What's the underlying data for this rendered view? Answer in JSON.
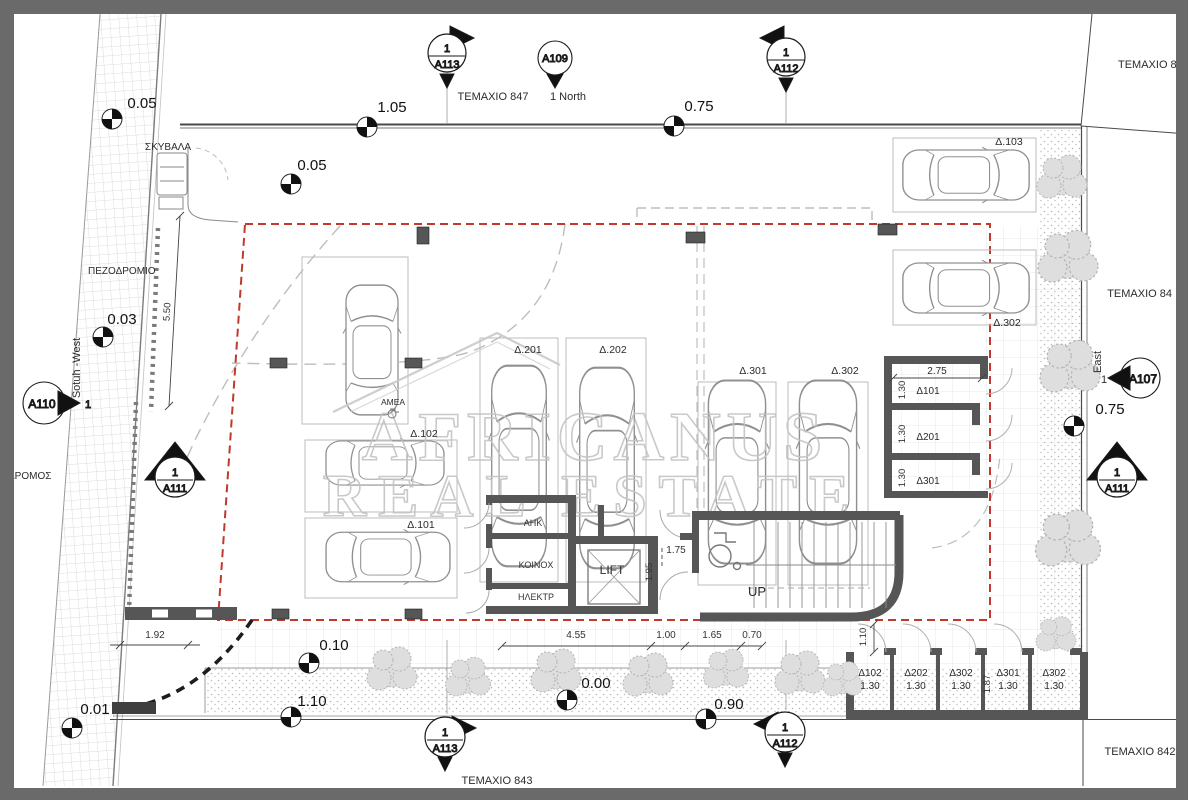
{
  "labels": {
    "temaxio_847": "ΤΕΜΑΧΙΟ 847",
    "temaxio_846": "ΤΕΜΑΧΙΟ 846",
    "temaxio_84": "ΤΕΜΑΧΙΟ 84",
    "temaxio_842": "ΤΕΜΑΧΙΟ 842",
    "temaxio_843": "ΤΕΜΑΧΙΟ 843",
    "north": "1 North",
    "east": "East",
    "east_num": "1",
    "south_west": "Sotuh -West",
    "sidewalk": "ΠΕΖΟΔΡΟΜΙΟ",
    "road": "ΔΡΟΜΟΣ",
    "garbage": "ΣΚΥΒΑΛΑ"
  },
  "sections": {
    "num": "1",
    "a113": "A113",
    "a112": "A112",
    "a111": "A111",
    "a110": "A110",
    "a109": "A109",
    "a107": "A107"
  },
  "levels": {
    "top_left": "0.05",
    "top_mid": "1.05",
    "top_right": "0.75",
    "inner": "0.05",
    "west": "0.03",
    "east": "0.75",
    "plant": "0.10",
    "gate": "1.10",
    "zero": "0.00",
    "south": "0.90",
    "road": "0.01"
  },
  "dims": {
    "w192": "1.92",
    "w455": "4.55",
    "w100": "1.00",
    "w165": "1.65",
    "w070": "0.70",
    "h550": "5.50",
    "w175": "1.75",
    "h195": "1.95",
    "w275": "2.75",
    "h130": "1.30",
    "h110": "1.10",
    "h187": "1.87"
  },
  "parking": {
    "p103": "Δ.103",
    "p302e": "Δ.302",
    "p201": "Δ.201",
    "p202": "Δ.202",
    "p301": "Δ.301",
    "p302": "Δ.302",
    "p102": "Δ.102",
    "p101": "Δ.101",
    "amea": "ΑΜΕΑ"
  },
  "storage_right": {
    "width": "2.75",
    "depth": "1.30",
    "rooms": [
      "Δ101",
      "Δ201",
      "Δ301"
    ]
  },
  "storage_bottom": {
    "units": [
      {
        "label": "Δ102",
        "size": "1.30"
      },
      {
        "label": "Δ202",
        "size": "1.30"
      },
      {
        "label": "Δ302",
        "size": "1.30"
      },
      {
        "label": "Δ301",
        "size": "1.30"
      },
      {
        "label": "Δ302",
        "size": "1.30"
      }
    ],
    "height": "1.87",
    "offset": "1.10"
  },
  "core": {
    "rooms": [
      "ΑΗΚ",
      "ΚΟΙΝΟΧ",
      "ΗΛΕΚΤΡ"
    ],
    "lift": "LIFT",
    "stairs_up": "UP",
    "lobby_w": "1.75",
    "lobby_h": "1.95"
  },
  "watermark": {
    "line1": "AFRICANUS",
    "line2": "REAL ESTATE"
  },
  "colors": {
    "wall": "#575757",
    "red_boundary": "#bf3a2b",
    "watermark": "#c4c4c4",
    "frame": "#6a6a6a"
  }
}
